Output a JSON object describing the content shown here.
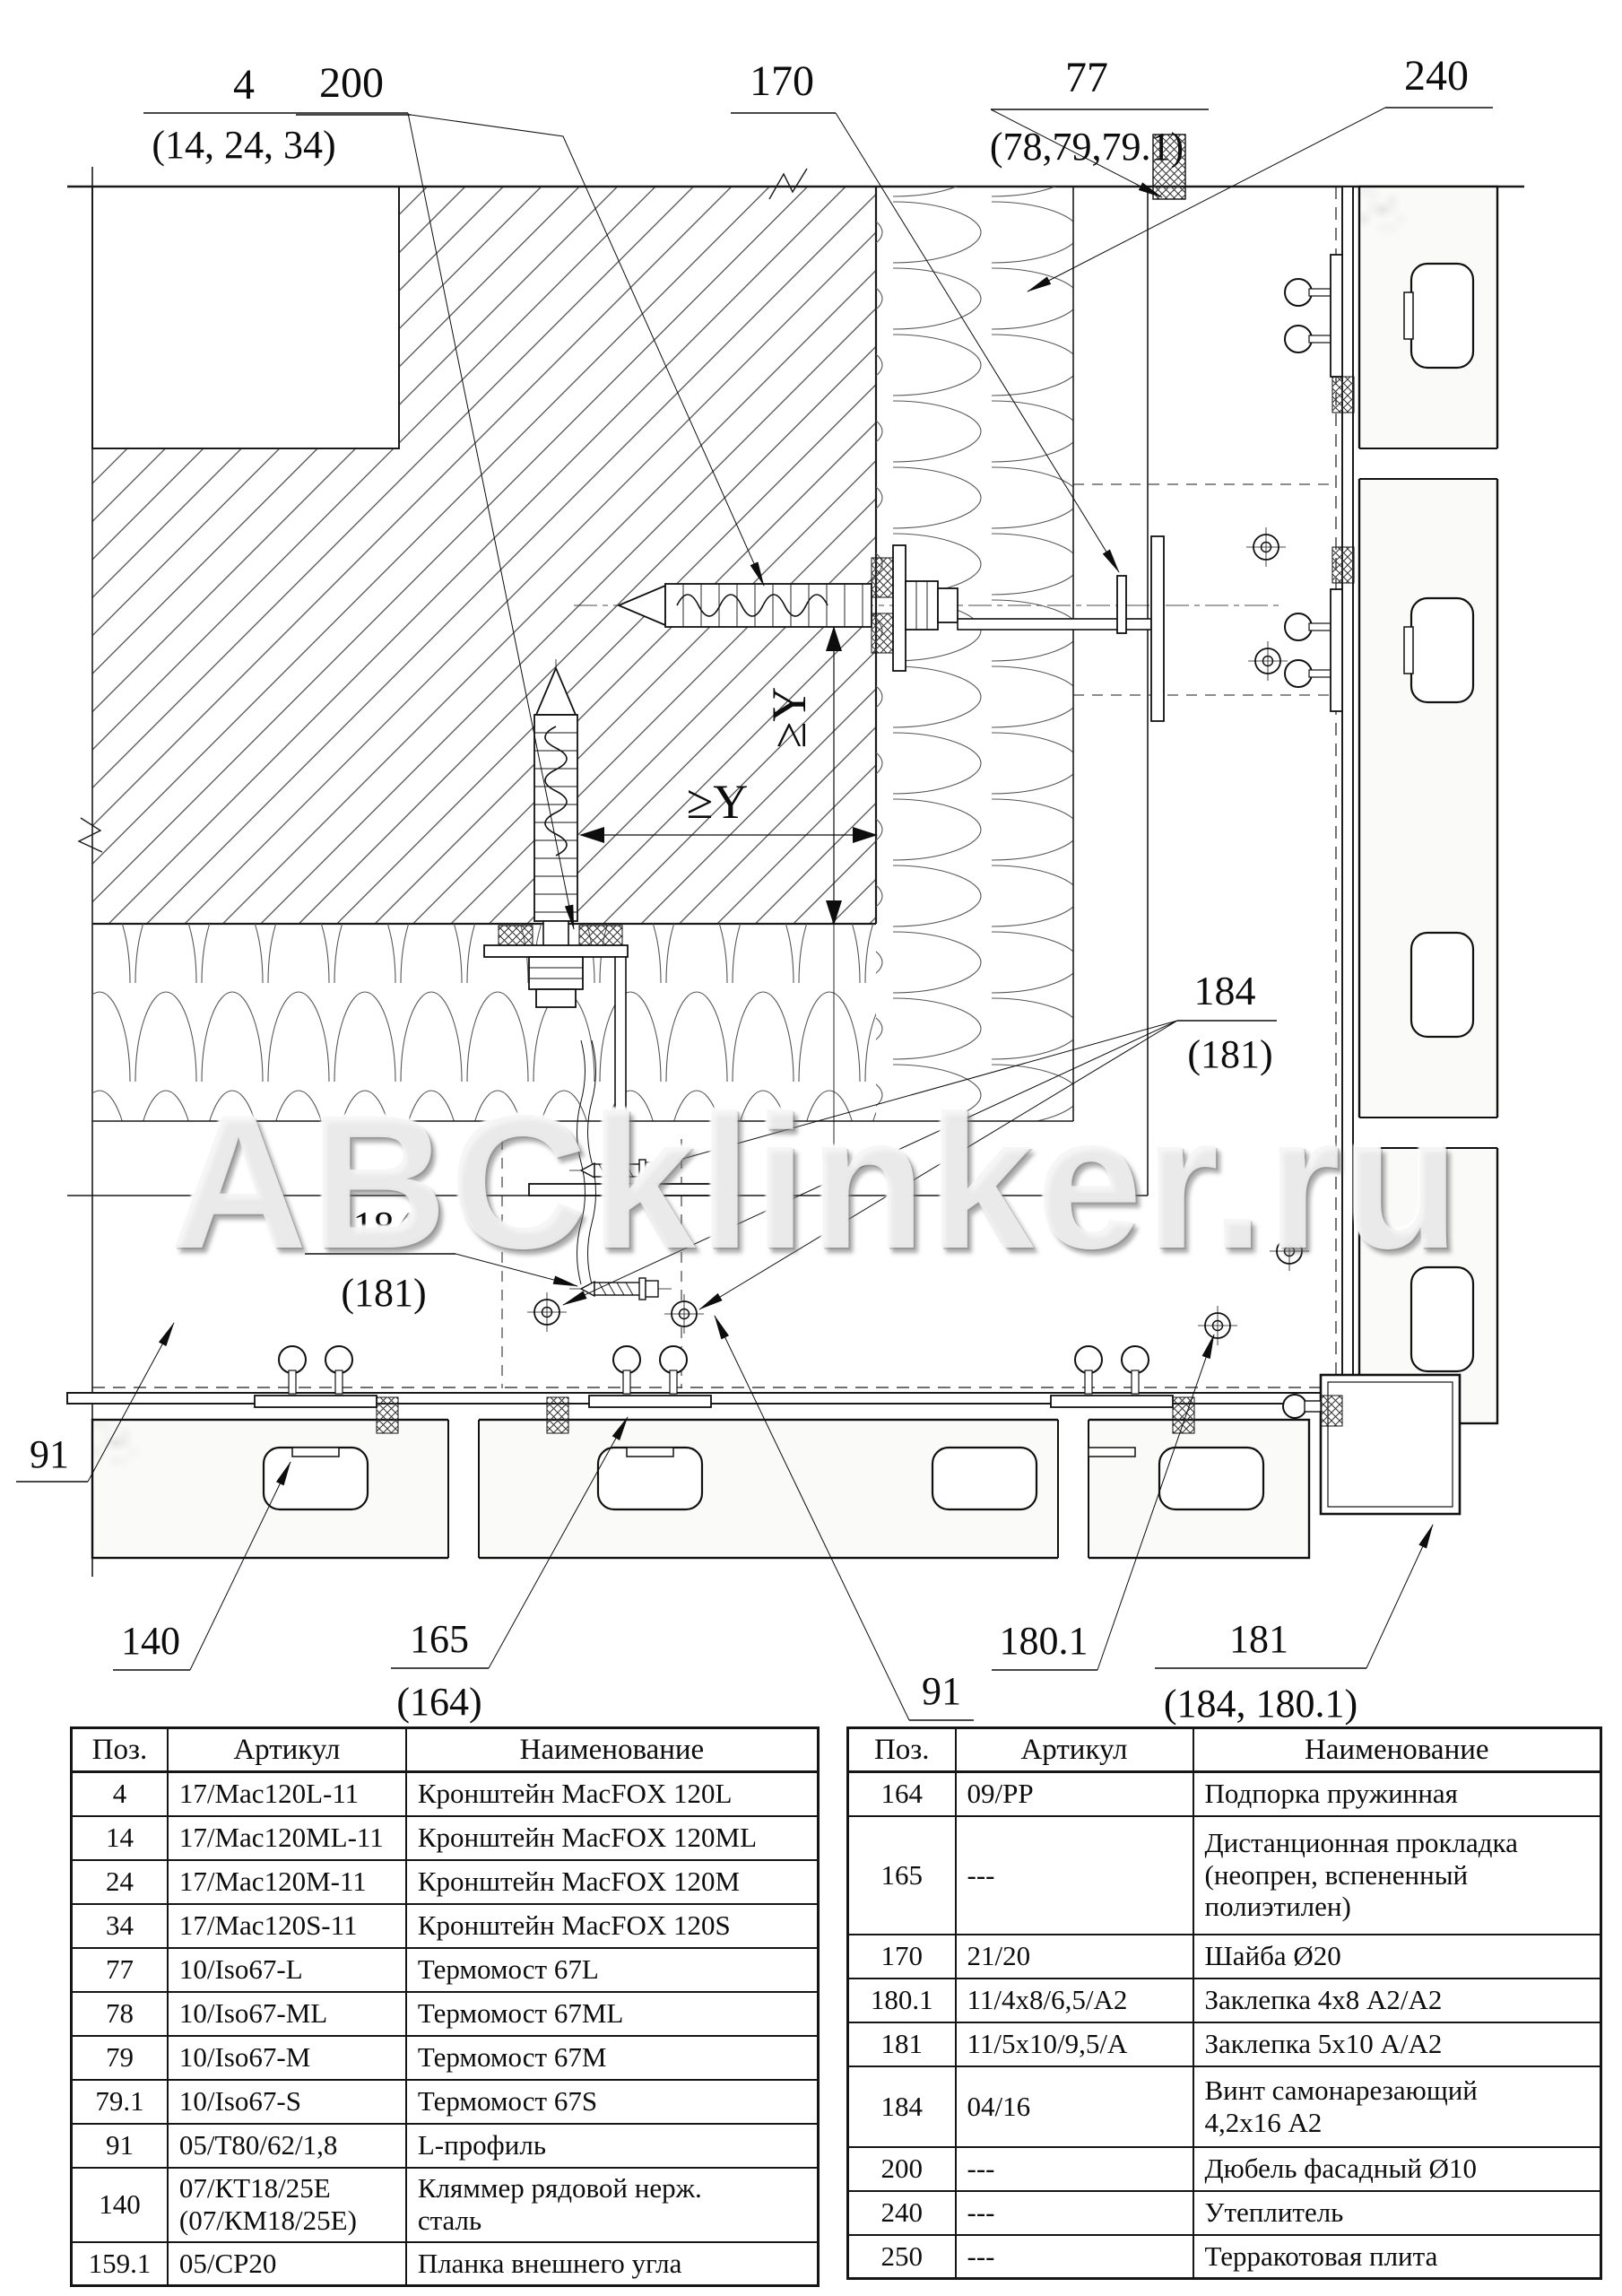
{
  "watermark": "ABCklinker.ru",
  "dimensions": {
    "vertical": "≥Y",
    "horizontal": "≥Y"
  },
  "callouts": {
    "bracket": {
      "num": "4",
      "alt": "(14, 24, 34)"
    },
    "dowel": {
      "num": "200"
    },
    "washer": {
      "num": "170"
    },
    "thermo": {
      "num": "77",
      "alt": "(78,79,79.1)"
    },
    "insulation": {
      "num": "240"
    },
    "screw_right": {
      "num": "184",
      "alt": "(181)"
    },
    "screw_left": {
      "num": "184",
      "alt": "(181)"
    },
    "profile_left": {
      "num": "91"
    },
    "profile_bottom": {
      "num": "91"
    },
    "clamp": {
      "num": "140"
    },
    "spacer": {
      "num": "165",
      "alt": "(164)"
    },
    "rivet_small": {
      "num": "180.1"
    },
    "rivet": {
      "num": "181",
      "alt": "(184, 180.1)"
    }
  },
  "tables": {
    "left": {
      "headers": [
        "Поз.",
        "Артикул",
        "Наименование"
      ],
      "rows": [
        {
          "pos": "4",
          "art": "17/Mac120L-11",
          "name": "Кронштейн MacFOX 120L"
        },
        {
          "pos": "14",
          "art": "17/Mac120ML-11",
          "name": "Кронштейн MacFOX 120ML"
        },
        {
          "pos": "24",
          "art": "17/Mac120M-11",
          "name": "Кронштейн MacFOX 120M"
        },
        {
          "pos": "34",
          "art": "17/Mac120S-11",
          "name": "Кронштейн MacFOX 120S"
        },
        {
          "pos": "77",
          "art": "10/Iso67-L",
          "name": "Термомост 67L"
        },
        {
          "pos": "78",
          "art": "10/Iso67-ML",
          "name": "Термомост 67ML"
        },
        {
          "pos": "79",
          "art": "10/Iso67-M",
          "name": "Термомост 67M"
        },
        {
          "pos": "79.1",
          "art": "10/Iso67-S",
          "name": "Термомост 67S"
        },
        {
          "pos": "91",
          "art": "05/Т80/62/1,8",
          "name": "L-профиль"
        },
        {
          "pos": "140",
          "art": "07/КТ18/25Е\n(07/КМ18/25Е)",
          "name": "Кляммер рядовой нерж.\nсталь"
        },
        {
          "pos": "159.1",
          "art": "05/СР20",
          "name": "Планка внешнего угла"
        }
      ]
    },
    "right": {
      "headers": [
        "Поз.",
        "Артикул",
        "Наименование"
      ],
      "rows": [
        {
          "pos": "164",
          "art": "09/PP",
          "name": "Подпорка пружинная"
        },
        {
          "pos": "165",
          "art": "---",
          "name": "Дистанционная прокладка\n(неопрен, вспененный\nполиэтилен)"
        },
        {
          "pos": "170",
          "art": "21/20",
          "name": "Шайба Ø20"
        },
        {
          "pos": "180.1",
          "art": "11/4x8/6,5/А2",
          "name": "Заклепка 4x8 А2/А2"
        },
        {
          "pos": "181",
          "art": "11/5x10/9,5/А",
          "name": "Заклепка 5x10 А/А2"
        },
        {
          "pos": "184",
          "art": "04/16",
          "name": "Винт самонарезающий\n4,2x16 А2"
        },
        {
          "pos": "200",
          "art": "---",
          "name": "Дюбель фасадный Ø10"
        },
        {
          "pos": "240",
          "art": "---",
          "name": "Утеплитель"
        },
        {
          "pos": "250",
          "art": "---",
          "name": "Терракотовая плита"
        }
      ]
    }
  }
}
